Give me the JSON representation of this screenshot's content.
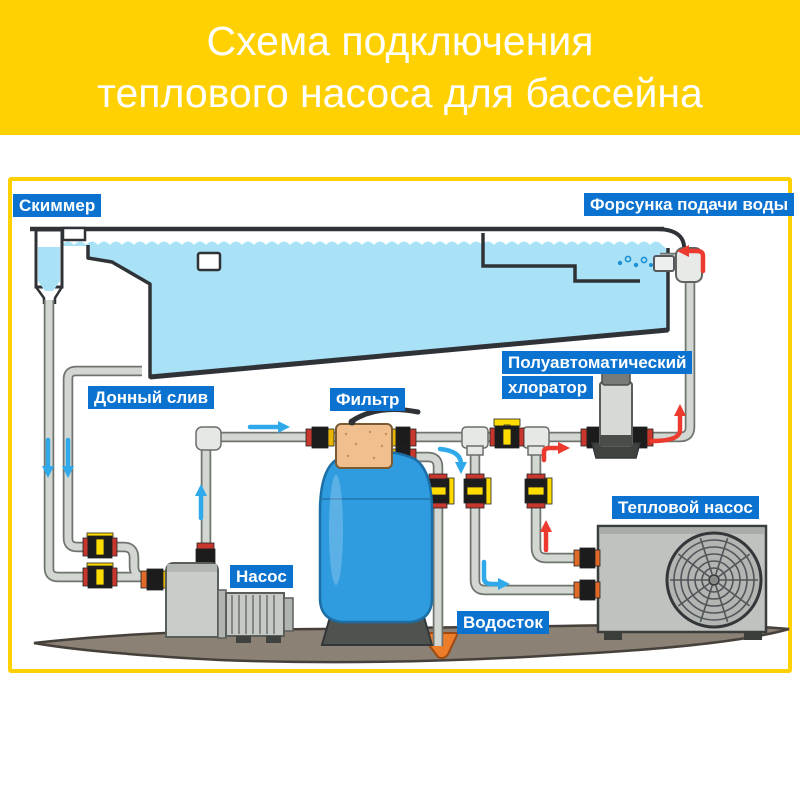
{
  "header": {
    "title_line1": "Схема подключения",
    "title_line2": "теплового насоса для бассейна"
  },
  "diagram": {
    "labels": {
      "skimmer": "Скиммер",
      "inlet_nozzle": "Форсунка подачи воды",
      "bottom_drain": "Донный слив",
      "filter": "Фильтр",
      "pump": "Насос",
      "chlorinator_line1": "Полуавтоматический",
      "chlorinator_line2": "хлоратор",
      "heat_pump": "Тепловой насос",
      "drain": "Водосток"
    },
    "colors": {
      "header_yellow": "#FFD103",
      "frame_yellow": "#FFD103",
      "label_blue": "#0B72D0",
      "water_blue": "#A9E2F7",
      "outline_dark": "#2F3337",
      "pipe_light": "#D3D7D2",
      "pipe_edge": "#70746F",
      "valve_yellow": "#FFDB00",
      "union_red": "#C8372D",
      "union_orange": "#E06A28",
      "arrow_blue": "#2FA9E9",
      "arrow_red": "#EC3A2E",
      "filter_tank_blue": "#2E9CDF",
      "multiport_tan": "#F1BE8D",
      "equipment_gray": "#BFC3BF",
      "ground_brown": "#8B8174",
      "funnel_orange": "#ED7D2B"
    }
  }
}
